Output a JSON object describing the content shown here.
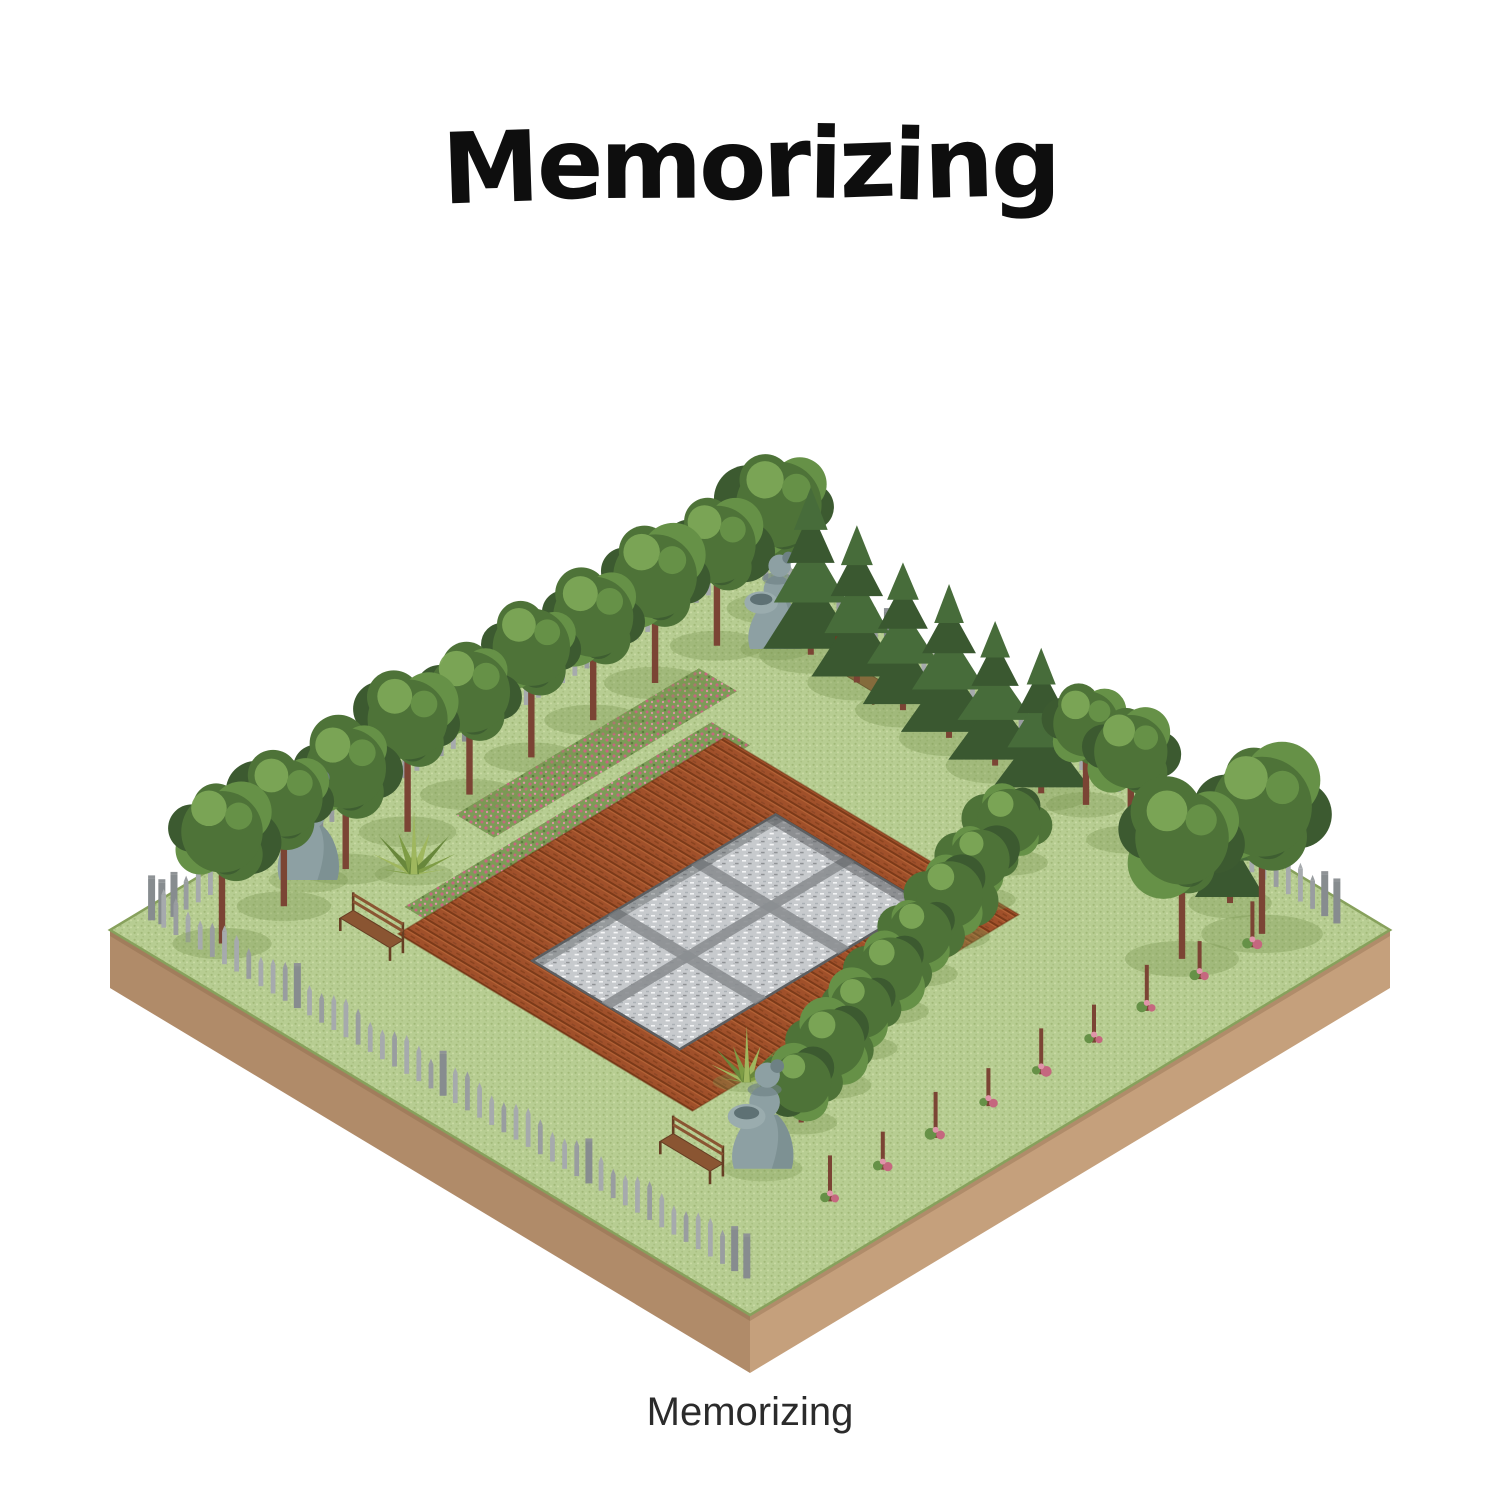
{
  "title": "Memorizing",
  "caption": "Memorizing",
  "palette": {
    "background": "#ffffff",
    "title_color": "#0e0e0e",
    "caption_color": "#2b2b2b",
    "grass_base": "#b7cd92",
    "grass_dot_dark": "#8fa964",
    "grass_dot_light": "#cbdca6",
    "grass_rim": "#87a15c",
    "soil_side_light": "#c5a07c",
    "soil_side_dark": "#b08b69",
    "soil_side_edge": "#9b7757",
    "field_soil": "#a0502a",
    "field_furrow_dark": "#6e3212",
    "field_furrow_light": "#bd6a3a",
    "water_base": "#c7cacd",
    "water_sparkle": "#f3f4f5",
    "water_shade": "#8e9194",
    "water_rim": "#5c5f62",
    "fence_gray": "#a6aaad",
    "fence_gray_dark": "#878c8f",
    "trunk_brown": "#7b4434",
    "canopy_dark": "#3c5a30",
    "canopy_mid": "#4e7338",
    "canopy_light": "#669147",
    "canopy_highlight": "#7ca756",
    "conifer_dark": "#3a5830",
    "conifer_mid": "#476c3a",
    "flower_pink": "#c5677f",
    "flower_pink_light": "#e094a9",
    "flowerbed_green": "#7d9c57",
    "statue_gray": "#8da0a3",
    "statue_gray_dark": "#6e8184",
    "bench_wood": "#8a5532",
    "bench_wood_dark": "#663e23",
    "agave_green": "#7e9c45",
    "agave_green_light": "#9fb75e",
    "agave_green_dark": "#68873b",
    "shadow_green": "#79954f"
  },
  "scene": {
    "label": "isometric square garden plot",
    "nw_tree_row": {
      "label": "row of deciduous trees along northwest edge",
      "count": 10
    },
    "ne_conifer_row": {
      "label": "row of conifer trees along northeast edge",
      "count": 6
    },
    "corner_trees": {
      "label": "tall trees near east corner",
      "count": 4
    },
    "hedge_row": {
      "label": "row of bushy trees beside tilled field",
      "count": 8
    },
    "sapling_row": {
      "label": "row of staked flowering saplings along southeast edge",
      "count": 9
    },
    "flower_beds": {
      "label": "pink flower bed strips",
      "count": 2
    },
    "statues": {
      "label": "stone statues of girl holding basin",
      "count": 3
    },
    "benches": {
      "label": "wooden garden benches",
      "count": 3
    },
    "agaves": {
      "label": "agave plants",
      "count": 2
    },
    "tilled_field": {
      "label": "red tilled soil plot",
      "count": 1
    },
    "water_pool": {
      "label": "sunken gray pool with six slabs",
      "count": 1
    },
    "fence": {
      "label": "gray picket fence on three sides",
      "sides": 3
    }
  }
}
